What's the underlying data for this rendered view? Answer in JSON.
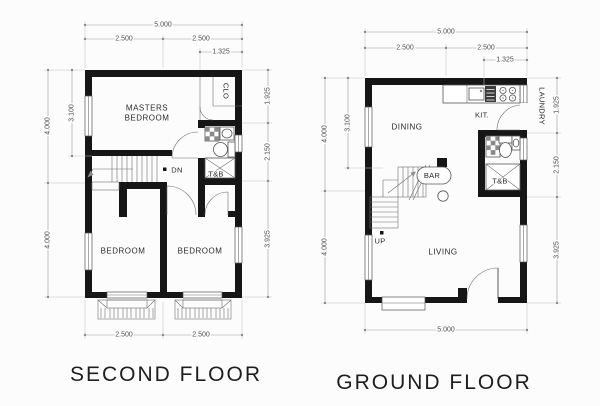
{
  "titles": {
    "second": "SECOND FLOOR",
    "ground": "GROUND FLOOR"
  },
  "second_floor": {
    "dims": {
      "top_total": "5.000",
      "top_left": "2.500",
      "top_right": "2.500",
      "top_sub": "1.325",
      "left_upper": "4.000",
      "left_lower": "4.000",
      "left_inner": "3.100",
      "right_top": "1.925",
      "right_mid": "2.150",
      "right_bottom": "3.925",
      "bottom_left": "2.500",
      "bottom_right": "2.500"
    },
    "labels": {
      "masters_line1": "MASTERS",
      "masters_line2": "BEDROOM",
      "closet": "CLO",
      "toilet": "T&B",
      "stair": "DN",
      "bedroom_left": "BEDROOM",
      "bedroom_right": "BEDROOM"
    }
  },
  "ground_floor": {
    "dims": {
      "top_total": "5.000",
      "top_left": "2.500",
      "top_right": "2.500",
      "top_sub": "1.325",
      "left_upper": "4.000",
      "left_lower": "4.000",
      "left_inner": "3.100",
      "right_top": "1.925",
      "right_mid": "2.150",
      "right_bottom": "3.925",
      "bottom_total": "5.000"
    },
    "labels": {
      "dining": "DINING",
      "kitchen": "KIT.",
      "laundry": "LAUNDRY",
      "toilet": "T&B",
      "bar": "BAR",
      "stair": "UP",
      "living": "LIVING"
    }
  },
  "colors": {
    "wall": "#161616",
    "text": "#2b2b2b",
    "bg": "#fcfcfc"
  }
}
